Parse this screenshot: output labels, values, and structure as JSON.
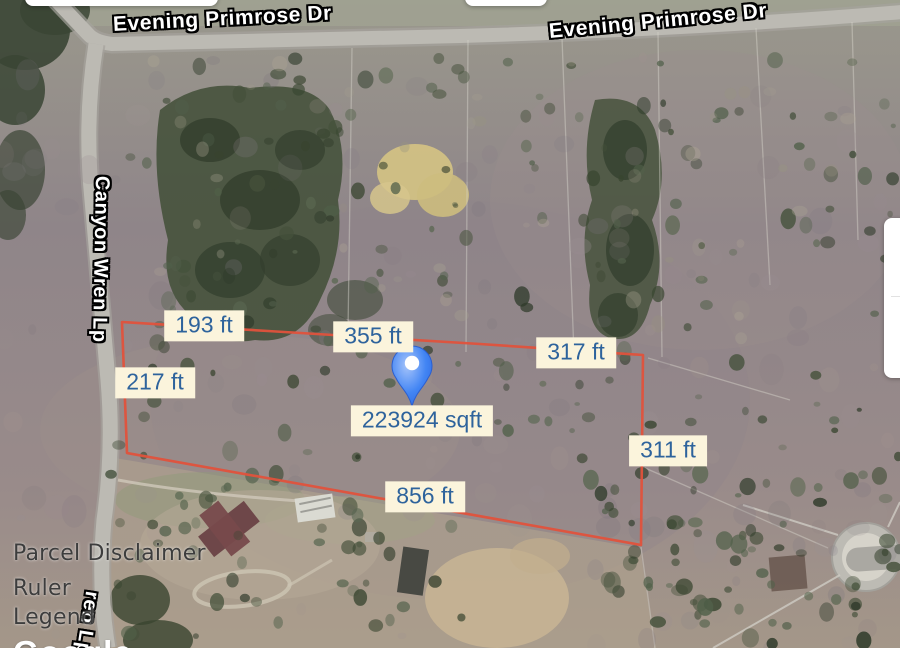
{
  "streets": {
    "evening_primrose_1": "Evening Primrose Dr",
    "evening_primrose_2": "Evening Primrose Dr",
    "canyon_wren": "Canyon Wren Lp",
    "canyon_wren_clipped": "ren Lp"
  },
  "parcel": {
    "area_label": "223924 sqft",
    "sides": {
      "top_left_segment": "193 ft",
      "top_middle_segment": "355 ft",
      "top_right_segment": "317 ft",
      "left_segment": "217 ft",
      "right_segment": "311 ft",
      "bottom_segment": "856 ft"
    },
    "boundary_color": "#e0523c",
    "label_bg": "#fbf4dc",
    "label_text_color": "#2e639c"
  },
  "marker": {
    "color": "#4285f4"
  },
  "menu": {
    "parcel_disclaimer": "Parcel Disclaimer",
    "ruler": "Ruler",
    "legend": "Legend"
  },
  "watermark": "Google"
}
